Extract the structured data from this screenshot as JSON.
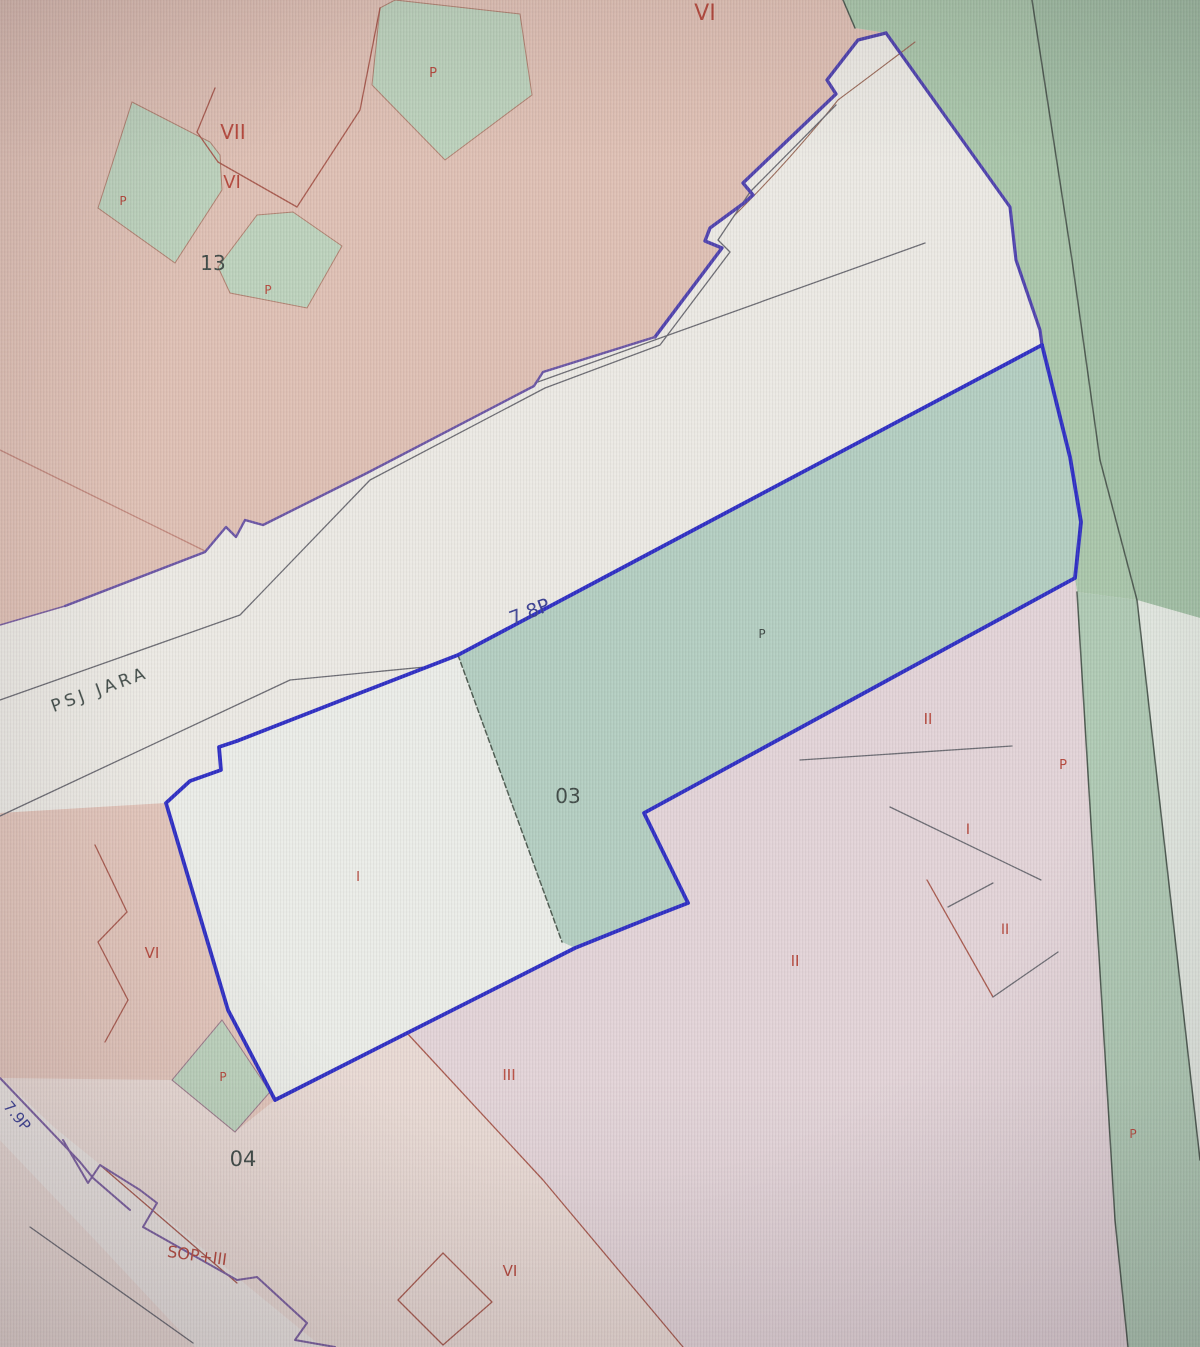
{
  "map": {
    "description": "Cadastral parcel map photographed from a monitor, with a selected parcel outlined in blue",
    "street": {
      "name": "PSJ JARA",
      "code_upper": "7.8P",
      "code_lower": "7.9P"
    },
    "labels": [
      {
        "text": "VI"
      },
      {
        "text": "P"
      },
      {
        "text": "VII"
      },
      {
        "text": "VI"
      },
      {
        "text": "P"
      },
      {
        "text": "13"
      },
      {
        "text": "P"
      },
      {
        "text": "7.8P"
      },
      {
        "text": "PSJ JARA"
      },
      {
        "text": "P"
      },
      {
        "text": "03"
      },
      {
        "text": "II"
      },
      {
        "text": "P"
      },
      {
        "text": "I"
      },
      {
        "text": "I"
      },
      {
        "text": "VI"
      },
      {
        "text": "II"
      },
      {
        "text": "II"
      },
      {
        "text": "P"
      },
      {
        "text": "III"
      },
      {
        "text": "04"
      },
      {
        "text": "P"
      },
      {
        "text": "7.9P"
      },
      {
        "text": "SOP+III"
      },
      {
        "text": "VI"
      }
    ]
  },
  "colors": {
    "pink-top": "#dfc0b4",
    "pink-left": "#e2c5ba",
    "bottom-pink": "#e9dad4",
    "lavender": "#e3d4d8",
    "green-dark": "#a9c6aa",
    "green-darker": "#a2c0a5",
    "green-mid": "#b3cec1",
    "green-light": "#bcd2bc",
    "green-strip": "#afcab4",
    "white-base": "#eceae4",
    "white-parcel": "#ebede8",
    "white-street": "#ebe5e1",
    "corner-light": "#e2e8e0",
    "blue": "#2e2ec4",
    "blue-soft": "#4f42ae",
    "violet": "#7a5fa0",
    "red-line": "#a85a4e",
    "gray-line": "#6b6b72",
    "dark-edge": "#4e5b51",
    "label-red": "#b5473b",
    "label-dark": "#3f4a46",
    "label-navy": "#3a3f92"
  }
}
